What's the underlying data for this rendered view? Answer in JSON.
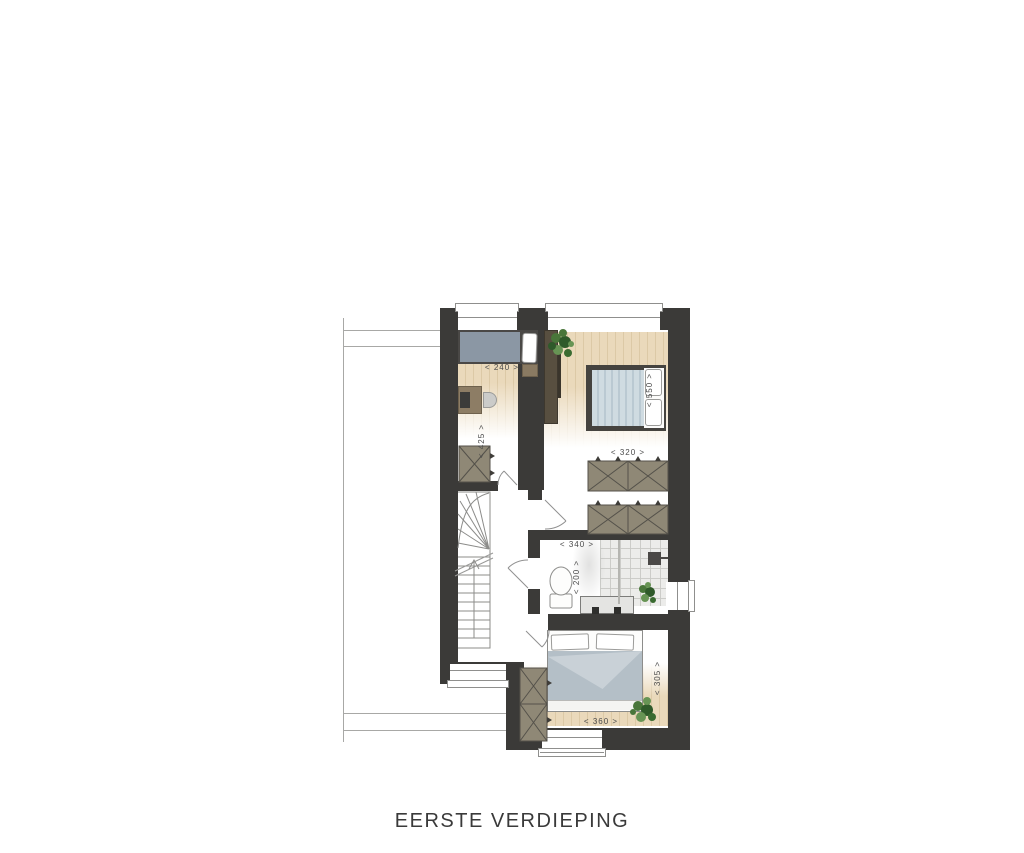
{
  "title": "EERSTE VERDIEPING",
  "plan": {
    "rooms": {
      "bedroom_left": {
        "width": "< 240 >",
        "depth": "< 425 >"
      },
      "bedroom_right": {
        "width": "< 320 >",
        "depth": "< 550 >"
      },
      "bathroom": {
        "width": "< 340 >",
        "depth": "< 200 >"
      },
      "bedroom_master": {
        "width": "< 360 >",
        "depth": "< 305 >"
      }
    },
    "colors": {
      "wall": "#3b3a38",
      "wood_floor": "#ead9bb",
      "wood_plank_line": "#dcc9a6",
      "furniture_taupe": "#8f8876",
      "bed_slate": "#8b97a4",
      "bed_stripe_light": "#cfdbe1",
      "bed_stripe_dark": "#bac9d2",
      "duvet": "#b4bfc7",
      "duvet_fold": "#c9d1d7",
      "cabinet_brown": "#584f40",
      "desk_brown": "#8d7d65",
      "plant_green": "#49763a",
      "neighbour_outline": "#a8a8a6",
      "text": "#3a3a3a"
    }
  }
}
